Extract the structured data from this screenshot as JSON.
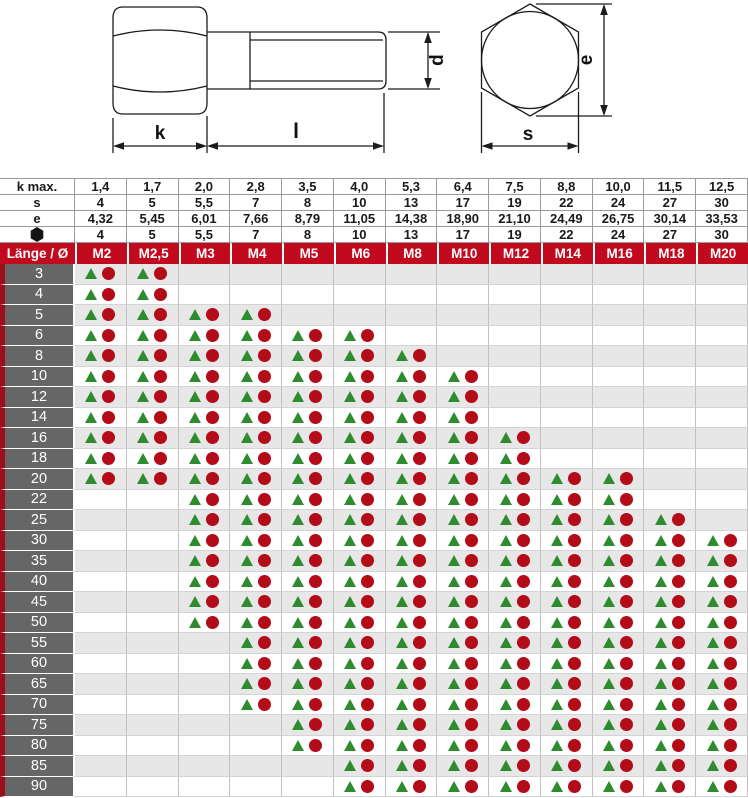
{
  "drawing": {
    "side_view_labels": {
      "k": "k",
      "l": "l",
      "d": "d"
    },
    "end_view_labels": {
      "e": "e",
      "s": "s"
    }
  },
  "table": {
    "spec_rows": [
      {
        "label": "k max.",
        "icon": null,
        "values": [
          "1,4",
          "1,7",
          "2,0",
          "2,8",
          "3,5",
          "4,0",
          "5,3",
          "6,4",
          "7,5",
          "8,8",
          "10,0",
          "11,5",
          "12,5"
        ]
      },
      {
        "label": "s",
        "icon": null,
        "values": [
          "4",
          "5",
          "5,5",
          "7",
          "8",
          "10",
          "13",
          "17",
          "19",
          "22",
          "24",
          "27",
          "30"
        ]
      },
      {
        "label": "e",
        "icon": null,
        "values": [
          "4,32",
          "5,45",
          "6,01",
          "7,66",
          "8,79",
          "11,05",
          "14,38",
          "18,90",
          "21,10",
          "24,49",
          "26,75",
          "30,14",
          "33,53"
        ]
      },
      {
        "label": "",
        "icon": "hex-nut-icon",
        "values": [
          "4",
          "5",
          "5,5",
          "7",
          "8",
          "10",
          "13",
          "17",
          "19",
          "22",
          "24",
          "27",
          "30"
        ]
      }
    ],
    "header": {
      "corner": "Länge / Ø",
      "sizes": [
        "M2",
        "M2,5",
        "M3",
        "M4",
        "M5",
        "M6",
        "M8",
        "M10",
        "M12",
        "M14",
        "M16",
        "M18",
        "M20"
      ]
    },
    "marker_meaning": {
      "triangle": "green-triangle-marker",
      "circle": "red-circle-marker"
    },
    "rows": [
      {
        "length": "3",
        "available": [
          1,
          1,
          0,
          0,
          0,
          0,
          0,
          0,
          0,
          0,
          0,
          0,
          0
        ]
      },
      {
        "length": "4",
        "available": [
          1,
          1,
          0,
          0,
          0,
          0,
          0,
          0,
          0,
          0,
          0,
          0,
          0
        ]
      },
      {
        "length": "5",
        "available": [
          1,
          1,
          1,
          1,
          0,
          0,
          0,
          0,
          0,
          0,
          0,
          0,
          0
        ]
      },
      {
        "length": "6",
        "available": [
          1,
          1,
          1,
          1,
          1,
          1,
          0,
          0,
          0,
          0,
          0,
          0,
          0
        ]
      },
      {
        "length": "8",
        "available": [
          1,
          1,
          1,
          1,
          1,
          1,
          1,
          0,
          0,
          0,
          0,
          0,
          0
        ]
      },
      {
        "length": "10",
        "available": [
          1,
          1,
          1,
          1,
          1,
          1,
          1,
          1,
          0,
          0,
          0,
          0,
          0
        ]
      },
      {
        "length": "12",
        "available": [
          1,
          1,
          1,
          1,
          1,
          1,
          1,
          1,
          0,
          0,
          0,
          0,
          0
        ]
      },
      {
        "length": "14",
        "available": [
          1,
          1,
          1,
          1,
          1,
          1,
          1,
          1,
          0,
          0,
          0,
          0,
          0
        ]
      },
      {
        "length": "16",
        "available": [
          1,
          1,
          1,
          1,
          1,
          1,
          1,
          1,
          1,
          0,
          0,
          0,
          0
        ]
      },
      {
        "length": "18",
        "available": [
          1,
          1,
          1,
          1,
          1,
          1,
          1,
          1,
          1,
          0,
          0,
          0,
          0
        ]
      },
      {
        "length": "20",
        "available": [
          1,
          1,
          1,
          1,
          1,
          1,
          1,
          1,
          1,
          1,
          1,
          0,
          0
        ]
      },
      {
        "length": "22",
        "available": [
          0,
          0,
          1,
          1,
          1,
          1,
          1,
          1,
          1,
          1,
          1,
          0,
          0
        ]
      },
      {
        "length": "25",
        "available": [
          0,
          0,
          1,
          1,
          1,
          1,
          1,
          1,
          1,
          1,
          1,
          1,
          0
        ]
      },
      {
        "length": "30",
        "available": [
          0,
          0,
          1,
          1,
          1,
          1,
          1,
          1,
          1,
          1,
          1,
          1,
          1
        ]
      },
      {
        "length": "35",
        "available": [
          0,
          0,
          1,
          1,
          1,
          1,
          1,
          1,
          1,
          1,
          1,
          1,
          1
        ]
      },
      {
        "length": "40",
        "available": [
          0,
          0,
          1,
          1,
          1,
          1,
          1,
          1,
          1,
          1,
          1,
          1,
          1
        ]
      },
      {
        "length": "45",
        "available": [
          0,
          0,
          1,
          1,
          1,
          1,
          1,
          1,
          1,
          1,
          1,
          1,
          1
        ]
      },
      {
        "length": "50",
        "available": [
          0,
          0,
          1,
          1,
          1,
          1,
          1,
          1,
          1,
          1,
          1,
          1,
          1
        ]
      },
      {
        "length": "55",
        "available": [
          0,
          0,
          0,
          1,
          1,
          1,
          1,
          1,
          1,
          1,
          1,
          1,
          1
        ]
      },
      {
        "length": "60",
        "available": [
          0,
          0,
          0,
          1,
          1,
          1,
          1,
          1,
          1,
          1,
          1,
          1,
          1
        ]
      },
      {
        "length": "65",
        "available": [
          0,
          0,
          0,
          1,
          1,
          1,
          1,
          1,
          1,
          1,
          1,
          1,
          1
        ]
      },
      {
        "length": "70",
        "available": [
          0,
          0,
          0,
          1,
          1,
          1,
          1,
          1,
          1,
          1,
          1,
          1,
          1
        ]
      },
      {
        "length": "75",
        "available": [
          0,
          0,
          0,
          0,
          1,
          1,
          1,
          1,
          1,
          1,
          1,
          1,
          1
        ]
      },
      {
        "length": "80",
        "available": [
          0,
          0,
          0,
          0,
          1,
          1,
          1,
          1,
          1,
          1,
          1,
          1,
          1
        ]
      },
      {
        "length": "85",
        "available": [
          0,
          0,
          0,
          0,
          0,
          1,
          1,
          1,
          1,
          1,
          1,
          1,
          1
        ]
      },
      {
        "length": "90",
        "available": [
          0,
          0,
          0,
          0,
          0,
          1,
          1,
          1,
          1,
          1,
          1,
          1,
          1
        ]
      }
    ]
  },
  "colors": {
    "header_red": "#c20a1e",
    "circle_red": "#b30b18",
    "triangle_green": "#2e8b2e",
    "length_label_gray": "#666666",
    "left_stripe_red": "#9b0f1a",
    "alt_row_gray": "#e7e7e7"
  }
}
